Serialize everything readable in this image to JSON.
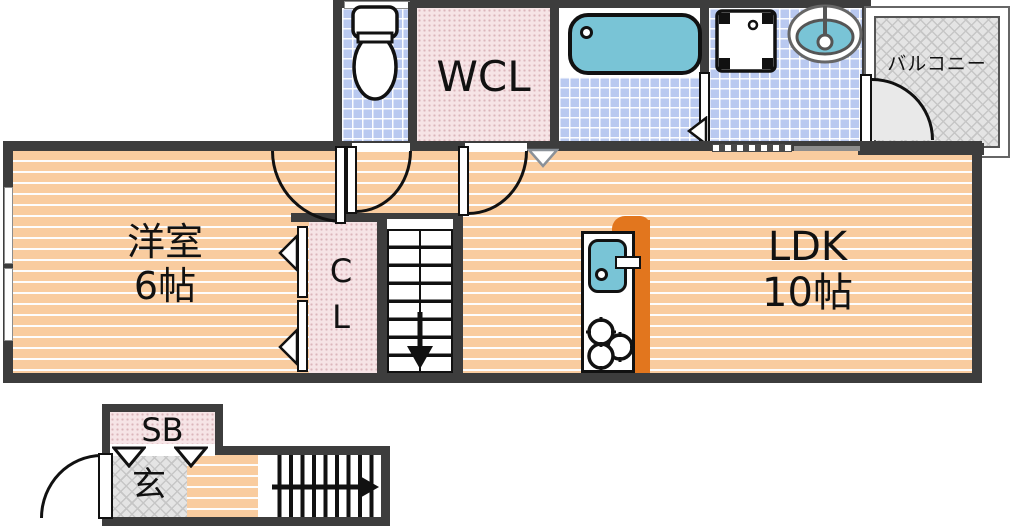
{
  "title": "1LDK apartment floor plan",
  "rooms": {
    "youshitsu": {
      "line1": "洋室",
      "line2": "6帖"
    },
    "ldk": {
      "line1": "LDK",
      "line2": "10帖"
    },
    "wcl": {
      "label": "WCL"
    },
    "cl": {
      "line1": "C",
      "line2": "L"
    },
    "balcony": {
      "label": "バルコニー"
    },
    "sb": {
      "label": "SB"
    },
    "genkan": {
      "label": "玄"
    }
  },
  "colors": {
    "wall": "#3d3d3d",
    "wood_floor": "#f9cc9f",
    "tile_blue": "#b9c9f0",
    "fixture_teal": "#79c4d6",
    "closet_pink": "#f6e4e6",
    "balcony_gray": "#e4e4e4",
    "kitchen_orange": "#e2761e"
  }
}
